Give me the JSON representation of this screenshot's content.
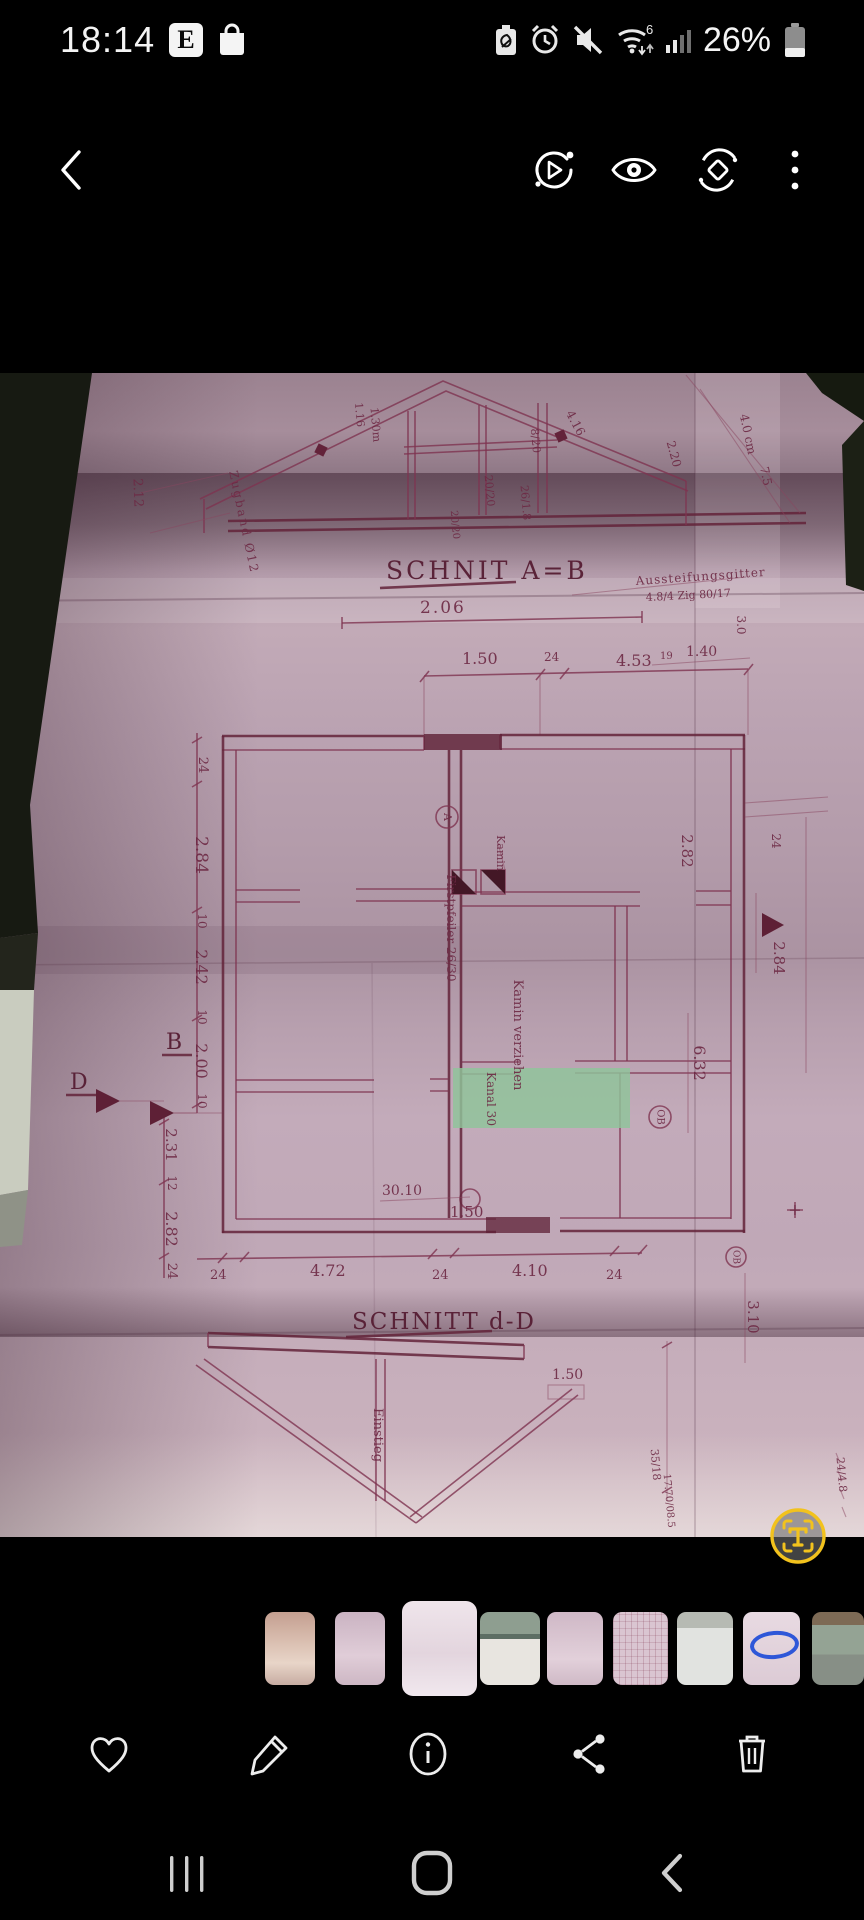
{
  "status_bar": {
    "time": "18:14",
    "e_badge": "E",
    "wifi_label": "6",
    "battery_percent": "26%",
    "notification_icons": [
      "e-badge",
      "shopping-bag-icon"
    ],
    "system_icons": [
      "battery-saver-icon",
      "alarm-icon",
      "mute-icon",
      "wifi-icon",
      "signal-icon",
      "battery-icon"
    ]
  },
  "toolbar": {
    "icons": [
      "back-icon",
      "motion-photo-icon",
      "eye-icon",
      "rotate-icon",
      "more-icon"
    ]
  },
  "photo": {
    "description": "Folded architectural blueprint, magenta ink on pink paper, green highlighter mark",
    "highlight_color": "#8fc49a",
    "titles": {
      "ab": "SCHNIT A=B",
      "cd": "SCHNITT d-D"
    },
    "labels": {
      "d206": "2.06",
      "d150": "1.50",
      "d24": "24",
      "d453": "4.53",
      "d140": "1.40",
      "d19": "19",
      "l24a": "24",
      "l284": "2.84",
      "l10a": "10",
      "l242": "2.42",
      "l10b": "10",
      "l200": "2.00",
      "l10c": "10",
      "l231": "2.31",
      "l12": "12",
      "l282": "2.82",
      "l24b": "24",
      "b24a": "24",
      "b472": "4.72",
      "b24b": "24",
      "b410": "4.10",
      "b24c": "24",
      "r24": "24",
      "r30": "3.0",
      "r282": "2.82",
      "r284": "2.84",
      "r310": "3.10",
      "r632": "6.32",
      "t212": "2.12",
      "t116": "1.16",
      "t130": "1.30m",
      "t820": "8/20",
      "t2020a": "20/20",
      "t2020b": "20/20",
      "t2618": "26/1.8",
      "t416": "4.16",
      "t220": "2.20",
      "zugband": "Zugband Ø12",
      "aussteif1": "Aussteifungsgitter",
      "aussteif2": "4.8/4  Zig 80/17",
      "abstand": "4.0 cm",
      "m75": "7.5",
      "mB": "B",
      "mD": "D",
      "mA": "A",
      "mOB": "OB",
      "m3010": "30.10",
      "m150b": "1.50",
      "first": "Firstpfeiler 26/30",
      "kamin1": "Kamin",
      "kamin2": "Kamin verziehen",
      "kanal": "Kanal 30",
      "einstieg": "Einstieg",
      "m150c": "1.50",
      "m3518": "35/18",
      "m1770": "17.70/08.5",
      "m2448": "24/4.8",
      "plus": "+"
    },
    "text_scan_button": {
      "icon": "text-scan-icon",
      "glyph": "T",
      "color": "#f2c21d"
    }
  },
  "thumbnails": {
    "count": 9,
    "selected_index": 2,
    "items": [
      {
        "desc": "blueprint photo warm tone"
      },
      {
        "desc": "blueprint photo pink"
      },
      {
        "desc": "current blueprint photo",
        "selected": true
      },
      {
        "desc": "folded paper gray-green band"
      },
      {
        "desc": "blueprint photo pink"
      },
      {
        "desc": "blueprint photo pink-white"
      },
      {
        "desc": "light gray paper"
      },
      {
        "desc": "blueprint with blue oval mark",
        "mark": "blue-oval"
      },
      {
        "desc": "paper brown and green tones"
      }
    ]
  },
  "action_bar": {
    "icons": [
      "favorite-icon",
      "edit-icon",
      "info-icon",
      "share-icon",
      "delete-icon"
    ]
  },
  "nav_bar": {
    "icons": [
      "recents-icon",
      "home-icon",
      "back-icon"
    ]
  }
}
